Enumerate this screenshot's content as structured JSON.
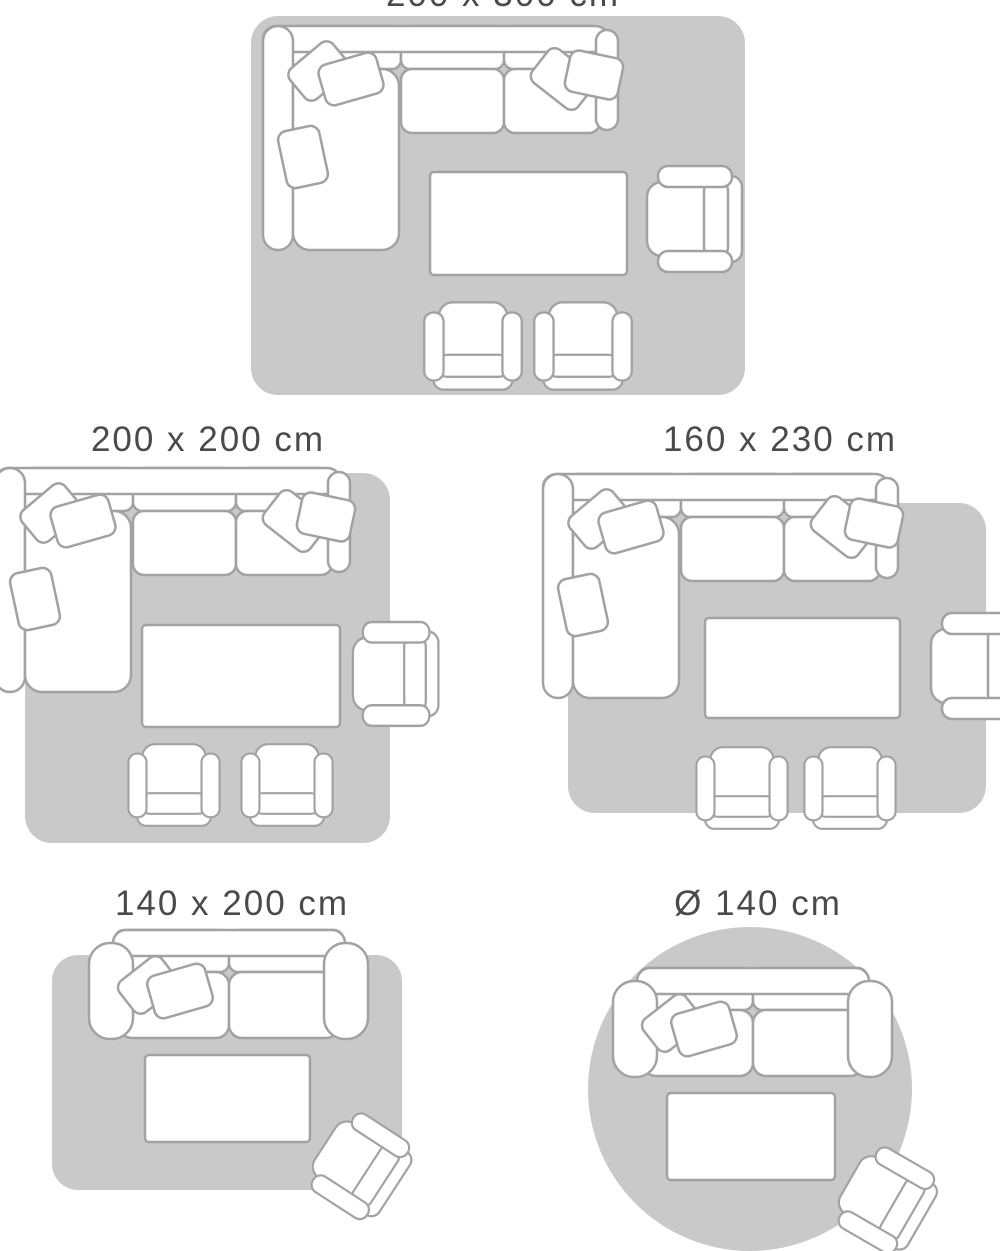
{
  "page": {
    "background": "#ffffff",
    "description": "Rug size guide showing living-room furniture arrangements on five rug sizes"
  },
  "colors": {
    "rug_fill": "#c9c9c9",
    "furniture_outline": "#a2a2a4",
    "furniture_fill": "#ffffff",
    "label_text": "#4a4a4c"
  },
  "diagrams": [
    {
      "label": "200 x 300 cm",
      "rug_shape": "rectangle",
      "furniture": [
        "corner sofa",
        "coffee table",
        "armchair",
        "armchair",
        "armchair"
      ]
    },
    {
      "label": "200 x 200 cm",
      "rug_shape": "square",
      "furniture": [
        "corner sofa",
        "coffee table",
        "armchair",
        "armchair",
        "armchair"
      ]
    },
    {
      "label": "160 x 230 cm",
      "rug_shape": "rectangle",
      "furniture": [
        "corner sofa",
        "coffee table",
        "armchair",
        "armchair",
        "armchair"
      ]
    },
    {
      "label": "140 x 200 cm",
      "rug_shape": "rectangle",
      "furniture": [
        "two-seat sofa",
        "coffee table",
        "armchair"
      ]
    },
    {
      "label": "Ø 140 cm",
      "rug_shape": "circle",
      "furniture": [
        "two-seat sofa",
        "coffee table",
        "armchair"
      ]
    }
  ]
}
